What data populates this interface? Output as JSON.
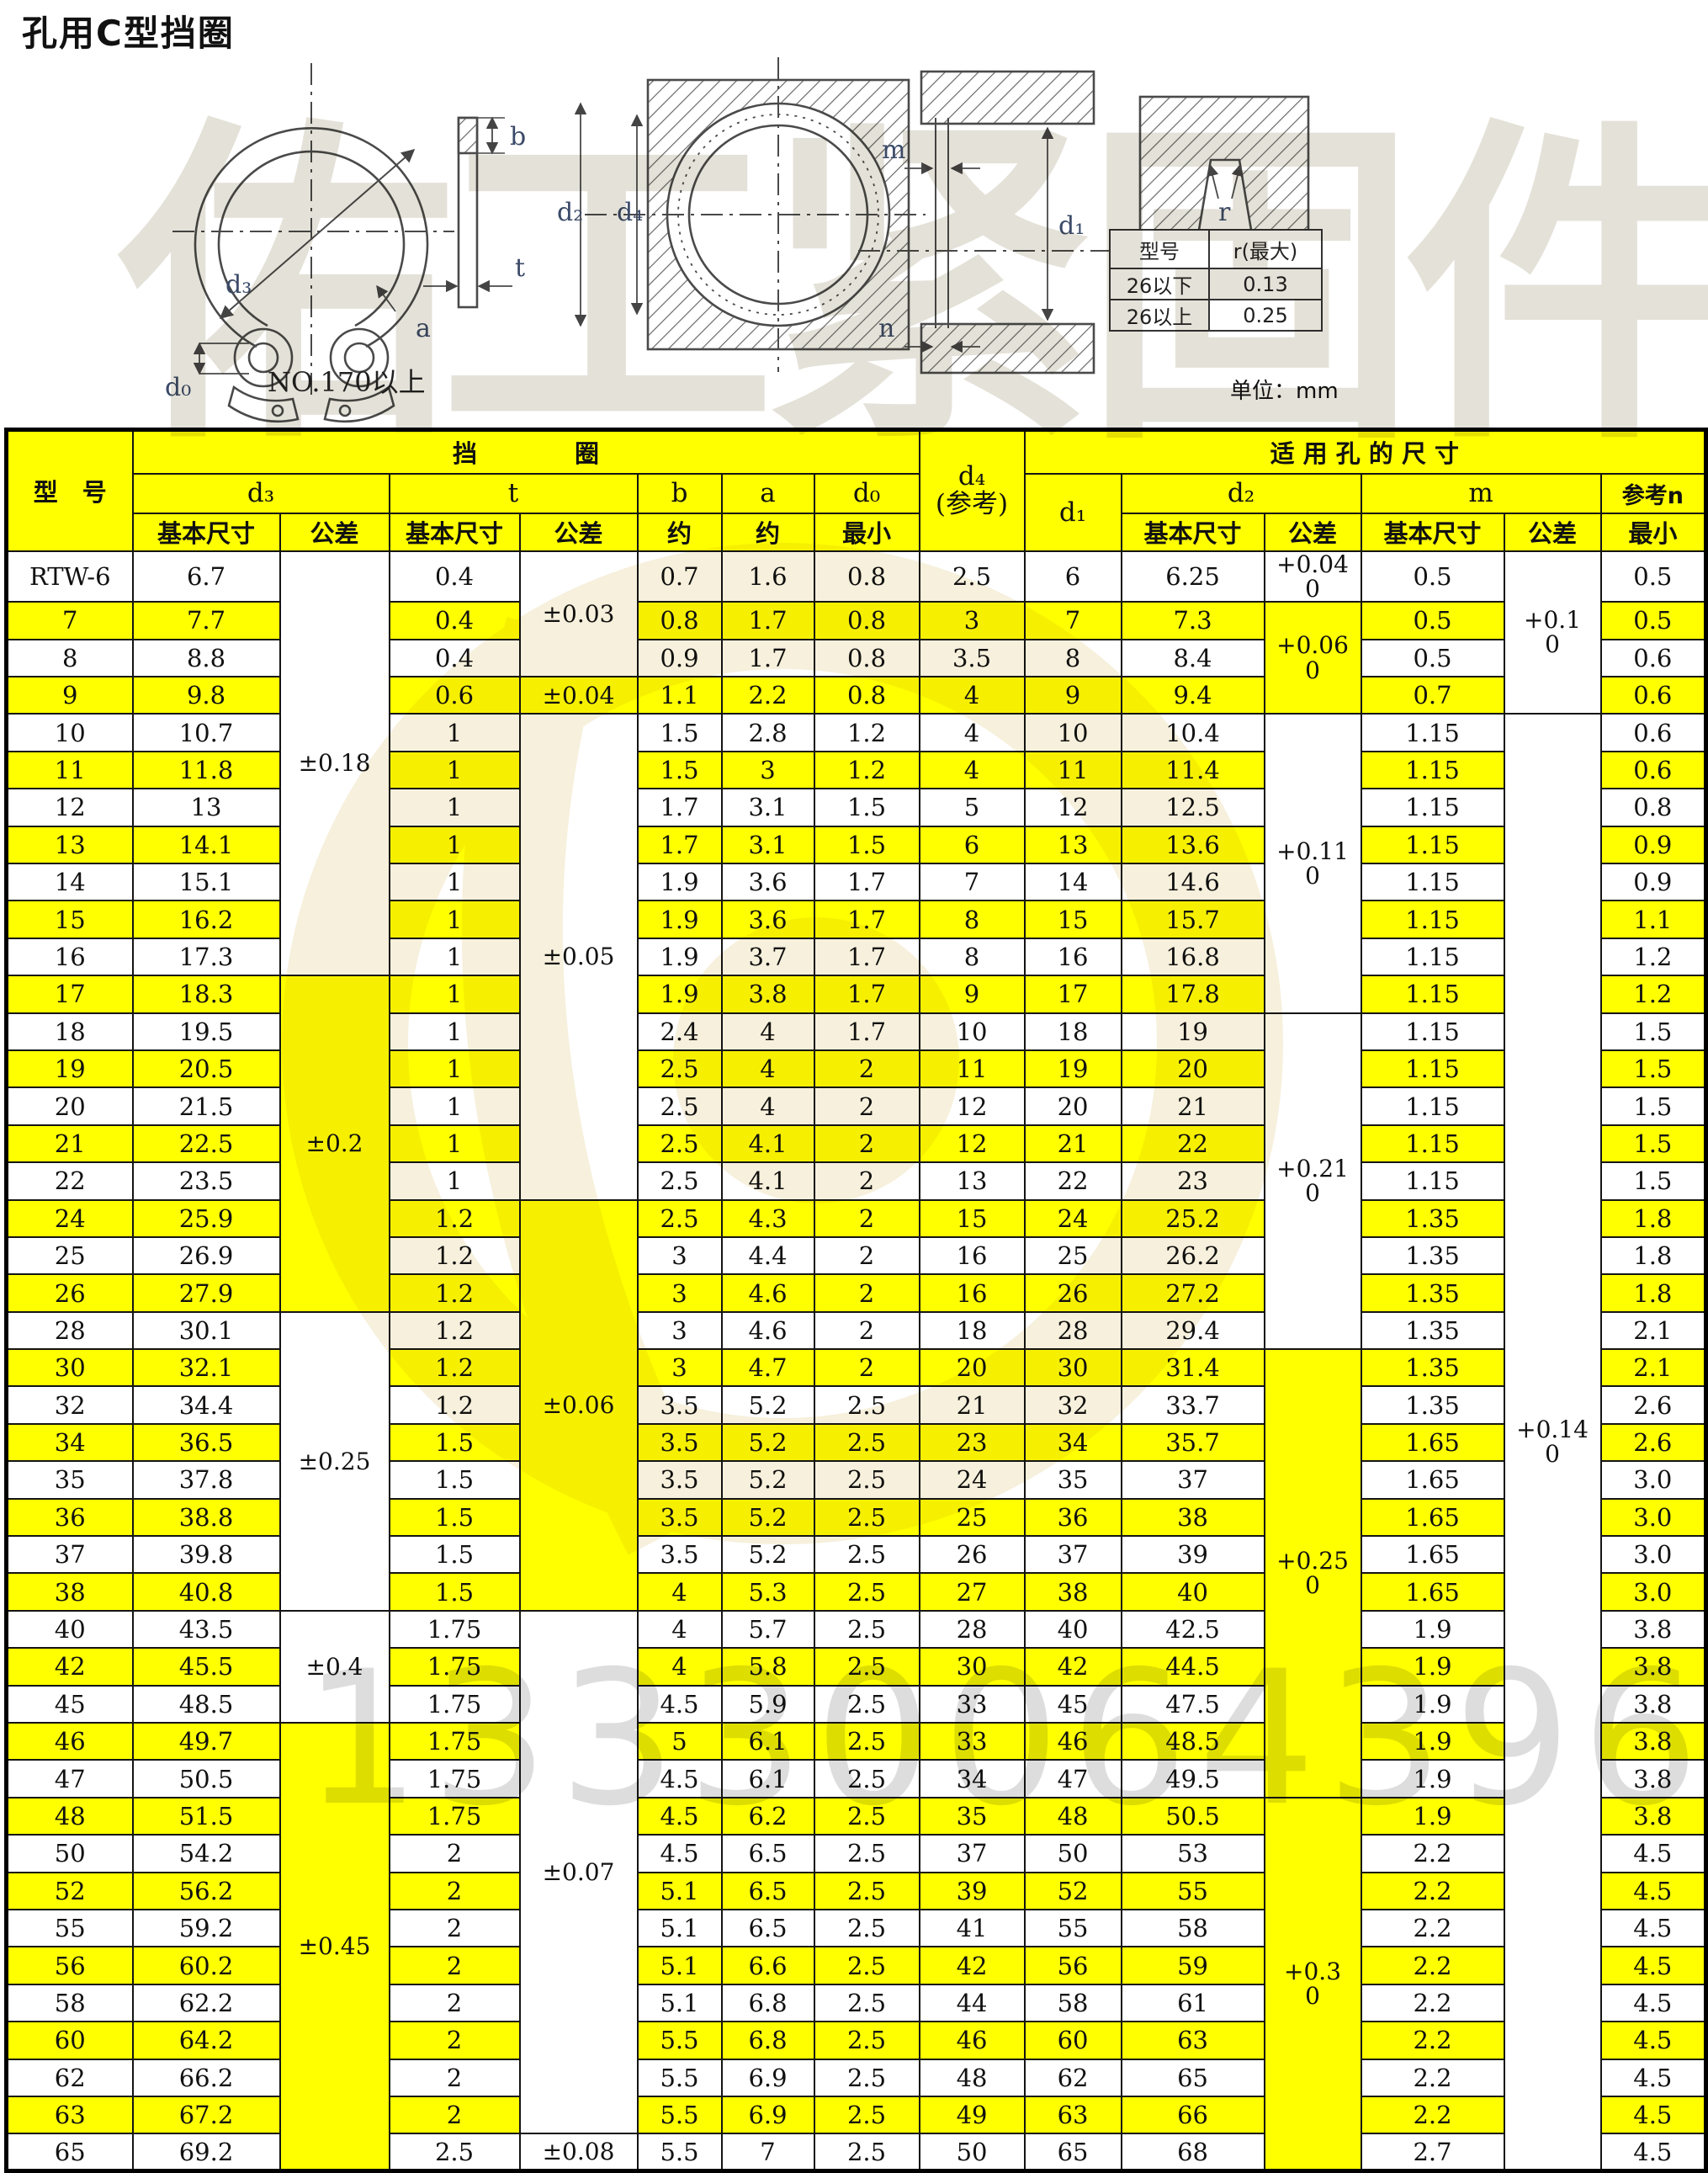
{
  "page": {
    "title": "孔用C型挡圈",
    "unit_label": "单位：mm"
  },
  "watermarks": {
    "brand": "佑工紧固件",
    "phone": "13330064396"
  },
  "r_table": {
    "col_headers": [
      "型号",
      "r(最大)"
    ],
    "rows": [
      [
        "26以下",
        "0.13"
      ],
      [
        "26以上",
        "0.25"
      ]
    ]
  },
  "drawings": {
    "front_view": {
      "caption": "NO.170以上",
      "d3": "d₃",
      "d0": "d₀",
      "a": "a",
      "b": "b",
      "t": "t"
    },
    "installed_view": {
      "d2": "d₂",
      "d4": "d₄"
    },
    "section_view": {
      "m": "m",
      "d1": "d₁",
      "n": "n"
    },
    "groove_view": {
      "r": "r"
    }
  },
  "main_table": {
    "header": {
      "model": "型　号",
      "ring_group": "挡　　　　圈",
      "hole_group": "适 用 孔 的 尺 寸",
      "d3": "d₃",
      "t": "t",
      "b": "b",
      "a": "a",
      "d0": "d₀",
      "d4": "d₄\n(参考)",
      "d1": "d₁",
      "d2": "d₂",
      "m": "m",
      "ref_n": "参考n",
      "basic": "基本尺寸",
      "tol": "公差",
      "approx": "约",
      "min": "最小"
    },
    "rows": [
      [
        "RTW-6",
        "6.7",
        "0.4",
        "0.7",
        "1.6",
        "0.8",
        "2.5",
        "6",
        "6.25",
        "0.5",
        "0.5"
      ],
      [
        "7",
        "7.7",
        "0.4",
        "0.8",
        "1.7",
        "0.8",
        "3",
        "7",
        "7.3",
        "0.5",
        "0.5"
      ],
      [
        "8",
        "8.8",
        "0.4",
        "0.9",
        "1.7",
        "0.8",
        "3.5",
        "8",
        "8.4",
        "0.5",
        "0.6"
      ],
      [
        "9",
        "9.8",
        "0.6",
        "1.1",
        "2.2",
        "0.8",
        "4",
        "9",
        "9.4",
        "0.7",
        "0.6"
      ],
      [
        "10",
        "10.7",
        "1",
        "1.5",
        "2.8",
        "1.2",
        "4",
        "10",
        "10.4",
        "1.15",
        "0.6"
      ],
      [
        "11",
        "11.8",
        "1",
        "1.5",
        "3",
        "1.2",
        "4",
        "11",
        "11.4",
        "1.15",
        "0.6"
      ],
      [
        "12",
        "13",
        "1",
        "1.7",
        "3.1",
        "1.5",
        "5",
        "12",
        "12.5",
        "1.15",
        "0.8"
      ],
      [
        "13",
        "14.1",
        "1",
        "1.7",
        "3.1",
        "1.5",
        "6",
        "13",
        "13.6",
        "1.15",
        "0.9"
      ],
      [
        "14",
        "15.1",
        "1",
        "1.9",
        "3.6",
        "1.7",
        "7",
        "14",
        "14.6",
        "1.15",
        "0.9"
      ],
      [
        "15",
        "16.2",
        "1",
        "1.9",
        "3.6",
        "1.7",
        "8",
        "15",
        "15.7",
        "1.15",
        "1.1"
      ],
      [
        "16",
        "17.3",
        "1",
        "1.9",
        "3.7",
        "1.7",
        "8",
        "16",
        "16.8",
        "1.15",
        "1.2"
      ],
      [
        "17",
        "18.3",
        "1",
        "1.9",
        "3.8",
        "1.7",
        "9",
        "17",
        "17.8",
        "1.15",
        "1.2"
      ],
      [
        "18",
        "19.5",
        "1",
        "2.4",
        "4",
        "1.7",
        "10",
        "18",
        "19",
        "1.15",
        "1.5"
      ],
      [
        "19",
        "20.5",
        "1",
        "2.5",
        "4",
        "2",
        "11",
        "19",
        "20",
        "1.15",
        "1.5"
      ],
      [
        "20",
        "21.5",
        "1",
        "2.5",
        "4",
        "2",
        "12",
        "20",
        "21",
        "1.15",
        "1.5"
      ],
      [
        "21",
        "22.5",
        "1",
        "2.5",
        "4.1",
        "2",
        "12",
        "21",
        "22",
        "1.15",
        "1.5"
      ],
      [
        "22",
        "23.5",
        "1",
        "2.5",
        "4.1",
        "2",
        "13",
        "22",
        "23",
        "1.15",
        "1.5"
      ],
      [
        "24",
        "25.9",
        "1.2",
        "2.5",
        "4.3",
        "2",
        "15",
        "24",
        "25.2",
        "1.35",
        "1.8"
      ],
      [
        "25",
        "26.9",
        "1.2",
        "3",
        "4.4",
        "2",
        "16",
        "25",
        "26.2",
        "1.35",
        "1.8"
      ],
      [
        "26",
        "27.9",
        "1.2",
        "3",
        "4.6",
        "2",
        "16",
        "26",
        "27.2",
        "1.35",
        "1.8"
      ],
      [
        "28",
        "30.1",
        "1.2",
        "3",
        "4.6",
        "2",
        "18",
        "28",
        "29.4",
        "1.35",
        "2.1"
      ],
      [
        "30",
        "32.1",
        "1.2",
        "3",
        "4.7",
        "2",
        "20",
        "30",
        "31.4",
        "1.35",
        "2.1"
      ],
      [
        "32",
        "34.4",
        "1.2",
        "3.5",
        "5.2",
        "2.5",
        "21",
        "32",
        "33.7",
        "1.35",
        "2.6"
      ],
      [
        "34",
        "36.5",
        "1.5",
        "3.5",
        "5.2",
        "2.5",
        "23",
        "34",
        "35.7",
        "1.65",
        "2.6"
      ],
      [
        "35",
        "37.8",
        "1.5",
        "3.5",
        "5.2",
        "2.5",
        "24",
        "35",
        "37",
        "1.65",
        "3.0"
      ],
      [
        "36",
        "38.8",
        "1.5",
        "3.5",
        "5.2",
        "2.5",
        "25",
        "36",
        "38",
        "1.65",
        "3.0"
      ],
      [
        "37",
        "39.8",
        "1.5",
        "3.5",
        "5.2",
        "2.5",
        "26",
        "37",
        "39",
        "1.65",
        "3.0"
      ],
      [
        "38",
        "40.8",
        "1.5",
        "4",
        "5.3",
        "2.5",
        "27",
        "38",
        "40",
        "1.65",
        "3.0"
      ],
      [
        "40",
        "43.5",
        "1.75",
        "4",
        "5.7",
        "2.5",
        "28",
        "40",
        "42.5",
        "1.9",
        "3.8"
      ],
      [
        "42",
        "45.5",
        "1.75",
        "4",
        "5.8",
        "2.5",
        "30",
        "42",
        "44.5",
        "1.9",
        "3.8"
      ],
      [
        "45",
        "48.5",
        "1.75",
        "4.5",
        "5.9",
        "2.5",
        "33",
        "45",
        "47.5",
        "1.9",
        "3.8"
      ],
      [
        "46",
        "49.7",
        "1.75",
        "5",
        "6.1",
        "2.5",
        "33",
        "46",
        "48.5",
        "1.9",
        "3.8"
      ],
      [
        "47",
        "50.5",
        "1.75",
        "4.5",
        "6.1",
        "2.5",
        "34",
        "47",
        "49.5",
        "1.9",
        "3.8"
      ],
      [
        "48",
        "51.5",
        "1.75",
        "4.5",
        "6.2",
        "2.5",
        "35",
        "48",
        "50.5",
        "1.9",
        "3.8"
      ],
      [
        "50",
        "54.2",
        "2",
        "4.5",
        "6.5",
        "2.5",
        "37",
        "50",
        "53",
        "2.2",
        "4.5"
      ],
      [
        "52",
        "56.2",
        "2",
        "5.1",
        "6.5",
        "2.5",
        "39",
        "52",
        "55",
        "2.2",
        "4.5"
      ],
      [
        "55",
        "59.2",
        "2",
        "5.1",
        "6.5",
        "2.5",
        "41",
        "55",
        "58",
        "2.2",
        "4.5"
      ],
      [
        "56",
        "60.2",
        "2",
        "5.1",
        "6.6",
        "2.5",
        "42",
        "56",
        "59",
        "2.2",
        "4.5"
      ],
      [
        "58",
        "62.2",
        "2",
        "5.1",
        "6.8",
        "2.5",
        "44",
        "58",
        "61",
        "2.2",
        "4.5"
      ],
      [
        "60",
        "64.2",
        "2",
        "5.5",
        "6.8",
        "2.5",
        "46",
        "60",
        "63",
        "2.2",
        "4.5"
      ],
      [
        "62",
        "66.2",
        "2",
        "5.5",
        "6.9",
        "2.5",
        "48",
        "62",
        "65",
        "2.2",
        "4.5"
      ],
      [
        "63",
        "67.2",
        "2",
        "5.5",
        "6.9",
        "2.5",
        "49",
        "63",
        "66",
        "2.2",
        "4.5"
      ],
      [
        "65",
        "69.2",
        "2.5",
        "5.5",
        "7",
        "2.5",
        "50",
        "65",
        "68",
        "2.7",
        "4.5"
      ]
    ],
    "spans": {
      "d3_tol": [
        {
          "label": "±0.18",
          "from": 0,
          "to": 10
        },
        {
          "label": "±0.2",
          "from": 11,
          "to": 19
        },
        {
          "label": "±0.25",
          "from": 20,
          "to": 27
        },
        {
          "label": "±0.4",
          "from": 28,
          "to": 30
        },
        {
          "label": "±0.45",
          "from": 31,
          "to": 42
        }
      ],
      "t_tol": [
        {
          "label": "±0.03",
          "from": 0,
          "to": 2
        },
        {
          "label": "±0.04",
          "from": 3,
          "to": 3
        },
        {
          "label": "±0.05",
          "from": 4,
          "to": 16
        },
        {
          "label": "±0.06",
          "from": 17,
          "to": 27
        },
        {
          "label": "±0.07",
          "from": 28,
          "to": 41
        },
        {
          "label": "±0.08",
          "from": 42,
          "to": 42
        }
      ],
      "d2_tol": [
        {
          "label": "+0.04\n0",
          "from": 0,
          "to": 0
        },
        {
          "label": "+0.06\n0",
          "from": 1,
          "to": 3
        },
        {
          "label": "+0.11\n0",
          "from": 4,
          "to": 11
        },
        {
          "label": "+0.21\n0",
          "from": 12,
          "to": 20
        },
        {
          "label": "+0.25\n0",
          "from": 21,
          "to": 32
        },
        {
          "label": "+0.3\n0",
          "from": 33,
          "to": 42
        }
      ],
      "m_tol": [
        {
          "label": "+0.1\n0",
          "from": 0,
          "to": 3
        },
        {
          "label": "+0.14\n0",
          "from": 4,
          "to": 42
        }
      ]
    }
  }
}
